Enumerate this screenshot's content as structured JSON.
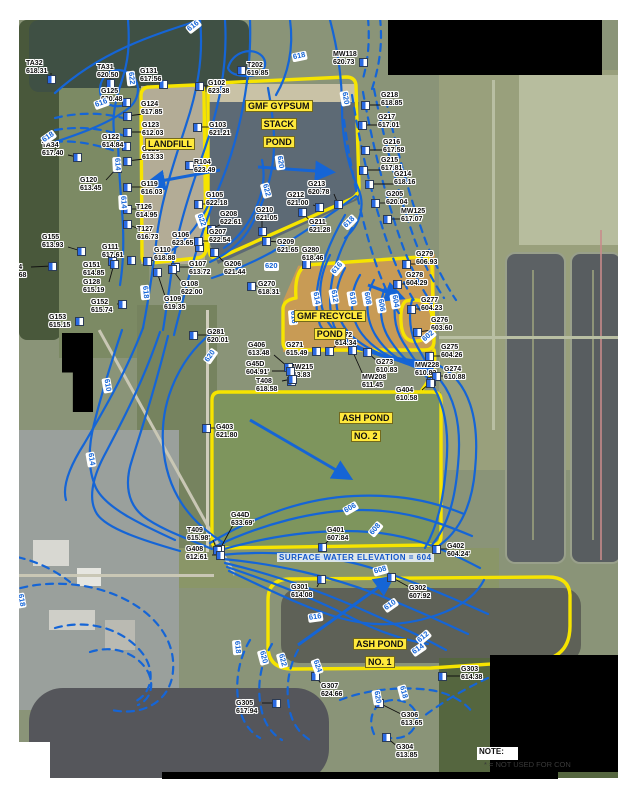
{
  "map": {
    "areas": [
      {
        "name": "landfill",
        "lines": [
          "LANDFILL"
        ],
        "x": 145,
        "y": 134
      },
      {
        "name": "gmf-gypsum-stack-pond",
        "lines": [
          "GMF GYPSUM",
          "STACK",
          "POND"
        ],
        "x": 245,
        "y": 96
      },
      {
        "name": "gmf-recycle-pond",
        "lines": [
          "GMF RECYCLE",
          "POND"
        ],
        "x": 294,
        "y": 306
      },
      {
        "name": "ash-pond-no-2",
        "lines": [
          "ASH POND",
          "NO. 2"
        ],
        "x": 339,
        "y": 408
      },
      {
        "name": "ash-pond-no-1",
        "lines": [
          "ASH POND",
          "NO. 1"
        ],
        "x": 353,
        "y": 634
      }
    ],
    "wells": [
      {
        "id": "TA32",
        "v": "618.31",
        "lx": 26,
        "ly": 60,
        "mx": 51,
        "my": 79
      },
      {
        "id": "TA31",
        "v": "620.50",
        "lx": 97,
        "ly": 64,
        "mx": 110,
        "my": 83
      },
      {
        "id": "G131",
        "v": "617.56",
        "lx": 140,
        "ly": 68,
        "mx": 163,
        "my": 84
      },
      {
        "id": "G125",
        "v": "620.48",
        "lx": 101,
        "ly": 88,
        "mx": 126,
        "my": 102
      },
      {
        "id": "G124",
        "v": "617.85",
        "lx": 141,
        "ly": 101,
        "mx": 127,
        "my": 116
      },
      {
        "id": "G123",
        "v": "612.03",
        "lx": 142,
        "ly": 122,
        "mx": 127,
        "my": 132
      },
      {
        "id": "G122",
        "v": "614.84",
        "lx": 102,
        "ly": 134,
        "mx": 126,
        "my": 146
      },
      {
        "id": "TA34",
        "v": "617.40",
        "lx": 42,
        "ly": 142,
        "mx": 77,
        "my": 157
      },
      {
        "id": "G121",
        "v": "613.33",
        "lx": 142,
        "ly": 146,
        "mx": 127,
        "my": 161
      },
      {
        "id": "G120",
        "v": "613.45",
        "lx": 80,
        "ly": 177,
        "mx": 117,
        "my": 168
      },
      {
        "id": "G119",
        "v": "616.03",
        "lx": 141,
        "ly": 181,
        "mx": 127,
        "my": 187
      },
      {
        "id": "T126",
        "v": "614.95",
        "lx": 136,
        "ly": 204,
        "mx": 127,
        "my": 209
      },
      {
        "id": "T127",
        "v": "616.73",
        "lx": 137,
        "ly": 226,
        "mx": 127,
        "my": 224
      },
      {
        "id": "G155",
        "v": "613.93",
        "lx": 42,
        "ly": 234,
        "mx": 81,
        "my": 251
      },
      {
        "id": "G111",
        "v": "617.61",
        "lx": 102,
        "ly": 244,
        "mx": 131,
        "my": 260
      },
      {
        "id": "G154",
        "v": "614.68",
        "lx": 5,
        "ly": 264,
        "mx": 52,
        "my": 266
      },
      {
        "id": "G151",
        "v": "614.85",
        "lx": 83,
        "ly": 262,
        "mx": 112,
        "my": 261
      },
      {
        "id": "G128",
        "v": "615.19",
        "lx": 83,
        "ly": 279,
        "mx": 114,
        "my": 264
      },
      {
        "id": "G152",
        "v": "615.74",
        "lx": 91,
        "ly": 299,
        "mx": 122,
        "my": 304
      },
      {
        "id": "G153",
        "v": "615.15",
        "lx": 49,
        "ly": 314,
        "mx": 79,
        "my": 321
      },
      {
        "id": "G106",
        "v": "623.65",
        "lx": 172,
        "ly": 232,
        "mx": 199,
        "my": 247
      },
      {
        "id": "G110",
        "v": "618.88",
        "lx": 154,
        "ly": 247,
        "mx": 147,
        "my": 261
      },
      {
        "id": "G107",
        "v": "613.72",
        "lx": 189,
        "ly": 261,
        "mx": 175,
        "my": 267
      },
      {
        "id": "G108",
        "v": "622.00",
        "lx": 181,
        "ly": 281,
        "mx": 172,
        "my": 269
      },
      {
        "id": "G109",
        "v": "619.35",
        "lx": 164,
        "ly": 296,
        "mx": 157,
        "my": 272
      },
      {
        "id": "G102",
        "v": "623.38",
        "lx": 208,
        "ly": 80,
        "mx": 199,
        "my": 86
      },
      {
        "id": "T202",
        "v": "619.85",
        "lx": 247,
        "ly": 62,
        "mx": 241,
        "my": 70
      },
      {
        "id": "MW118",
        "v": "620.73",
        "lx": 333,
        "ly": 51,
        "mx": 363,
        "my": 62
      },
      {
        "id": "G103",
        "v": "621.21",
        "lx": 209,
        "ly": 122,
        "mx": 197,
        "my": 127
      },
      {
        "id": "R104",
        "v": "623.49",
        "lx": 194,
        "ly": 159,
        "mx": 189,
        "my": 165
      },
      {
        "id": "G105",
        "v": "622.18",
        "lx": 206,
        "ly": 192,
        "mx": 198,
        "my": 204
      },
      {
        "id": "G208",
        "v": "622.61",
        "lx": 220,
        "ly": 211,
        "mx": 211,
        "my": 229
      },
      {
        "id": "G207",
        "v": "622.54",
        "lx": 209,
        "ly": 229,
        "mx": 198,
        "my": 241
      },
      {
        "id": "G210",
        "v": "621.05",
        "lx": 256,
        "ly": 207,
        "mx": 262,
        "my": 231
      },
      {
        "id": "G212",
        "v": "621.00",
        "lx": 287,
        "ly": 192,
        "mx": 319,
        "my": 207
      },
      {
        "id": "G213",
        "v": "620.78",
        "lx": 308,
        "ly": 181,
        "mx": 338,
        "my": 204
      },
      {
        "id": "G211",
        "v": "621.28",
        "lx": 309,
        "ly": 219,
        "mx": 302,
        "my": 212
      },
      {
        "id": "G209",
        "v": "621.65",
        "lx": 277,
        "ly": 239,
        "mx": 266,
        "my": 241
      },
      {
        "id": "G206",
        "v": "621.44",
        "lx": 224,
        "ly": 261,
        "mx": 214,
        "my": 252
      },
      {
        "id": "G280",
        "v": "618.46",
        "lx": 302,
        "ly": 247,
        "mx": 306,
        "my": 264
      },
      {
        "id": "G270",
        "v": "618.31",
        "lx": 258,
        "ly": 281,
        "mx": 251,
        "my": 286
      },
      {
        "id": "G218",
        "v": "618.85",
        "lx": 381,
        "ly": 92,
        "mx": 365,
        "my": 105
      },
      {
        "id": "G217",
        "v": "617.01",
        "lx": 378,
        "ly": 114,
        "mx": 362,
        "my": 125
      },
      {
        "id": "G216",
        "v": "617.58",
        "lx": 383,
        "ly": 139,
        "mx": 365,
        "my": 150
      },
      {
        "id": "G215",
        "v": "617.81",
        "lx": 381,
        "ly": 157,
        "mx": 363,
        "my": 170
      },
      {
        "id": "G214",
        "v": "618.16",
        "lx": 394,
        "ly": 171,
        "mx": 369,
        "my": 184
      },
      {
        "id": "G205",
        "v": "620.04",
        "lx": 386,
        "ly": 191,
        "mx": 375,
        "my": 203
      },
      {
        "id": "MW125",
        "v": "617.07",
        "lx": 401,
        "ly": 208,
        "mx": 387,
        "my": 219
      },
      {
        "id": "G279",
        "v": "606.93",
        "lx": 416,
        "ly": 251,
        "mx": 406,
        "my": 264
      },
      {
        "id": "G278",
        "v": "604.29",
        "lx": 406,
        "ly": 272,
        "mx": 397,
        "my": 284
      },
      {
        "id": "G277",
        "v": "604.23",
        "lx": 421,
        "ly": 297,
        "mx": 411,
        "my": 309
      },
      {
        "id": "G276",
        "v": "603.60",
        "lx": 431,
        "ly": 317,
        "mx": 417,
        "my": 332
      },
      {
        "id": "G275",
        "v": "604.26",
        "lx": 441,
        "ly": 344,
        "mx": 429,
        "my": 356
      },
      {
        "id": "MW228",
        "v": "610.83",
        "lx": 415,
        "ly": 362,
        "mx": 431,
        "my": 381
      },
      {
        "id": "G274",
        "v": "610.88",
        "lx": 444,
        "ly": 366,
        "mx": 436,
        "my": 376
      },
      {
        "id": "G271",
        "v": "615.49",
        "lx": 286,
        "ly": 342,
        "mx": 316,
        "my": 351
      },
      {
        "id": "G272",
        "v": "614.34",
        "lx": 335,
        "ly": 332,
        "mx": 329,
        "my": 351
      },
      {
        "id": "G273",
        "v": "610.83",
        "lx": 376,
        "ly": 359,
        "mx": 367,
        "my": 352
      },
      {
        "id": "MW215",
        "v": "613.83",
        "lx": 289,
        "ly": 364,
        "mx": 291,
        "my": 381
      },
      {
        "id": "MW208",
        "v": "611.45",
        "lx": 362,
        "ly": 374,
        "mx": 352,
        "my": 350
      },
      {
        "id": "G404",
        "v": "610.58",
        "lx": 396,
        "ly": 387,
        "mx": 430,
        "my": 383
      },
      {
        "id": "G281",
        "v": "620.01",
        "lx": 207,
        "ly": 329,
        "mx": 193,
        "my": 335
      },
      {
        "id": "G406",
        "v": "613.48",
        "lx": 248,
        "ly": 342,
        "mx": 288,
        "my": 367
      },
      {
        "id": "G45D",
        "v": "604.91'",
        "lx": 246,
        "ly": 361,
        "mx": 290,
        "my": 371
      },
      {
        "id": "T408",
        "v": "618.58",
        "lx": 256,
        "ly": 378,
        "mx": 292,
        "my": 379
      },
      {
        "id": "G403",
        "v": "621.80",
        "lx": 216,
        "ly": 424,
        "mx": 206,
        "my": 428
      },
      {
        "id": "G44D",
        "v": "633.69'",
        "lx": 231,
        "ly": 512,
        "mx": 220,
        "my": 549
      },
      {
        "id": "T409",
        "v": "615.98'",
        "lx": 187,
        "ly": 527,
        "mx": 217,
        "my": 550
      },
      {
        "id": "G408",
        "v": "612.61",
        "lx": 186,
        "ly": 546,
        "mx": 220,
        "my": 555
      },
      {
        "id": "G401",
        "v": "607.84",
        "lx": 327,
        "ly": 527,
        "mx": 322,
        "my": 547
      },
      {
        "id": "G402",
        "v": "604.24'",
        "lx": 447,
        "ly": 543,
        "mx": 436,
        "my": 549
      },
      {
        "id": "G301",
        "v": "614.08",
        "lx": 291,
        "ly": 584,
        "mx": 321,
        "my": 579
      },
      {
        "id": "G302",
        "v": "607.92",
        "lx": 409,
        "ly": 585,
        "mx": 391,
        "my": 577
      },
      {
        "id": "G303",
        "v": "614.38",
        "lx": 461,
        "ly": 666,
        "mx": 442,
        "my": 676
      },
      {
        "id": "G307",
        "v": "624.66",
        "lx": 321,
        "ly": 683,
        "mx": 315,
        "my": 676
      },
      {
        "id": "G305",
        "v": "617.94",
        "lx": 236,
        "ly": 700,
        "mx": 276,
        "my": 703
      },
      {
        "id": "G306",
        "v": "613.65",
        "lx": 401,
        "ly": 712,
        "mx": 379,
        "my": 703
      },
      {
        "id": "G304",
        "v": "613.85",
        "lx": 396,
        "ly": 744,
        "mx": 386,
        "my": 737
      }
    ],
    "contour_labels": [
      {
        "t": "616",
        "x": 186,
        "y": 22,
        "r": -38
      },
      {
        "t": "618",
        "x": 292,
        "y": 52,
        "r": -12
      },
      {
        "t": "622",
        "x": 124,
        "y": 74,
        "r": 84
      },
      {
        "t": "616",
        "x": 94,
        "y": 99,
        "r": -20
      },
      {
        "t": "618",
        "x": 41,
        "y": 133,
        "r": -35
      },
      {
        "t": "614",
        "x": 110,
        "y": 160,
        "r": 87
      },
      {
        "t": "614",
        "x": 116,
        "y": 198,
        "r": 87
      },
      {
        "t": "618",
        "x": 138,
        "y": 288,
        "r": 85
      },
      {
        "t": "620",
        "x": 273,
        "y": 158,
        "r": 82
      },
      {
        "t": "620",
        "x": 338,
        "y": 94,
        "r": 80
      },
      {
        "t": "622",
        "x": 194,
        "y": 216,
        "r": 70
      },
      {
        "t": "622",
        "x": 259,
        "y": 186,
        "r": 75
      },
      {
        "t": "620",
        "x": 264,
        "y": 262,
        "r": 0
      },
      {
        "t": "618",
        "x": 342,
        "y": 218,
        "r": -45
      },
      {
        "t": "616",
        "x": 330,
        "y": 264,
        "r": -50
      },
      {
        "t": "616",
        "x": 286,
        "y": 313,
        "r": 85
      },
      {
        "t": "614",
        "x": 309,
        "y": 294,
        "r": 80
      },
      {
        "t": "612",
        "x": 327,
        "y": 292,
        "r": 80
      },
      {
        "t": "610",
        "x": 345,
        "y": 294,
        "r": 80
      },
      {
        "t": "608",
        "x": 360,
        "y": 294,
        "r": 80
      },
      {
        "t": "606",
        "x": 374,
        "y": 301,
        "r": 80
      },
      {
        "t": "604",
        "x": 388,
        "y": 297,
        "r": 80
      },
      {
        "t": "602",
        "x": 421,
        "y": 332,
        "r": -40
      },
      {
        "t": "620",
        "x": 203,
        "y": 352,
        "r": -55
      },
      {
        "t": "610",
        "x": 100,
        "y": 381,
        "r": 80
      },
      {
        "t": "614",
        "x": 84,
        "y": 455,
        "r": 80
      },
      {
        "t": "606",
        "x": 343,
        "y": 504,
        "r": -30
      },
      {
        "t": "608",
        "x": 368,
        "y": 525,
        "r": -50
      },
      {
        "t": "608",
        "x": 373,
        "y": 566,
        "r": -15
      },
      {
        "t": "610",
        "x": 383,
        "y": 601,
        "r": -35
      },
      {
        "t": "616",
        "x": 308,
        "y": 613,
        "r": -8
      },
      {
        "t": "612",
        "x": 416,
        "y": 633,
        "r": -40
      },
      {
        "t": "614",
        "x": 411,
        "y": 645,
        "r": -35
      },
      {
        "t": "618",
        "x": 230,
        "y": 643,
        "r": 85
      },
      {
        "t": "620",
        "x": 256,
        "y": 653,
        "r": 75
      },
      {
        "t": "622",
        "x": 275,
        "y": 656,
        "r": 75
      },
      {
        "t": "624",
        "x": 310,
        "y": 662,
        "r": 70
      },
      {
        "t": "618",
        "x": 396,
        "y": 688,
        "r": 75
      },
      {
        "t": "620",
        "x": 370,
        "y": 693,
        "r": 80
      },
      {
        "t": "618",
        "x": 14,
        "y": 596,
        "r": 80
      }
    ],
    "arrows": [
      {
        "x1": 220,
        "y1": 170,
        "x2": 150,
        "y2": 183
      },
      {
        "x1": 258,
        "y1": 167,
        "x2": 330,
        "y2": 172
      },
      {
        "x1": 250,
        "y1": 420,
        "x2": 348,
        "y2": 477
      },
      {
        "x1": 298,
        "y1": 645,
        "x2": 390,
        "y2": 579
      },
      {
        "x1": 368,
        "y1": 285,
        "x2": 400,
        "y2": 297
      }
    ],
    "annotations": {
      "surface_water": "SURFACE WATER ELEVATION = 604",
      "surface_water_x": 277,
      "surface_water_y": 553,
      "note_title": "NOTE:",
      "note_body": "* = NOT USED FOR CON"
    },
    "colors": {
      "contour": "#1565d6",
      "boundary": "#f6e400",
      "area_label_bg": "#ffe93c",
      "marker_blue": "#2b6be4"
    }
  }
}
